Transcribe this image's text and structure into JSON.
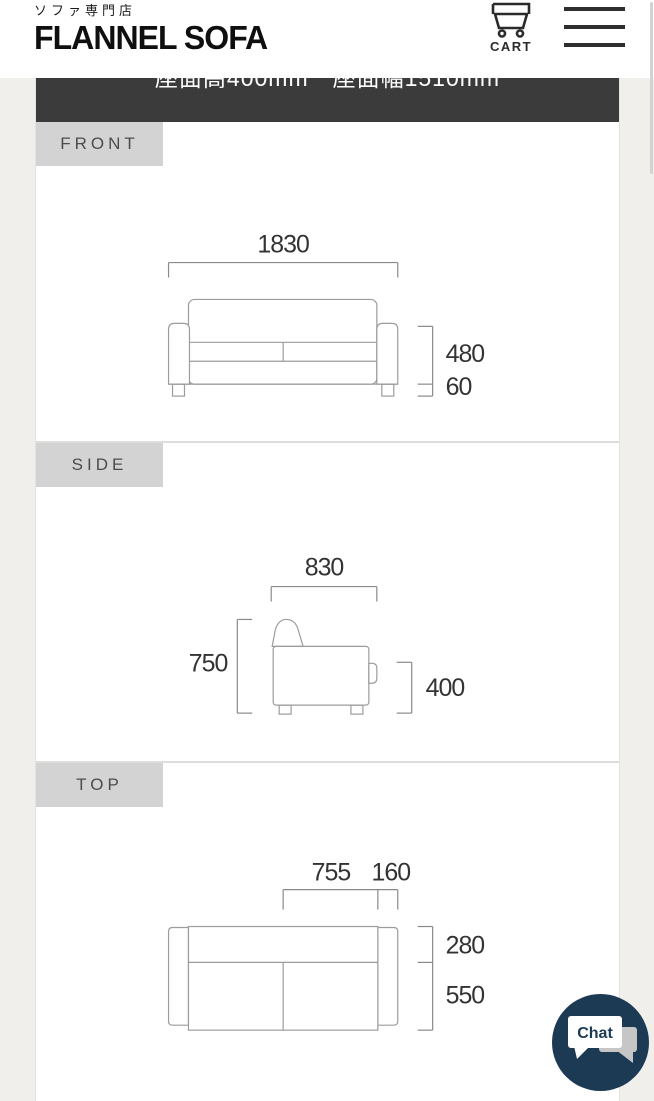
{
  "header": {
    "tagline": "ソファ専門店",
    "brand": "FLANNEL SOFA",
    "cart_label": "CART"
  },
  "spec_bar": {
    "text": "座面高400mm　座面幅1510mm"
  },
  "front": {
    "label": "FRONT",
    "width": "1830",
    "body_height": "480",
    "leg_height": "60"
  },
  "side": {
    "label": "SIDE",
    "depth": "830",
    "total_height": "750",
    "seat_height": "400"
  },
  "top": {
    "label": "TOP",
    "seat_width": "755",
    "arm_width": "160",
    "back_depth": "280",
    "seat_depth": "550"
  },
  "chat": {
    "label": "Chat"
  },
  "colors": {
    "page_bg": "#f0efec",
    "spec_bar_bg": "#3b3b3b",
    "label_bg": "#d3d3d3",
    "chat_bg": "#1d3a55",
    "diagram_line": "#9c9c9c"
  }
}
